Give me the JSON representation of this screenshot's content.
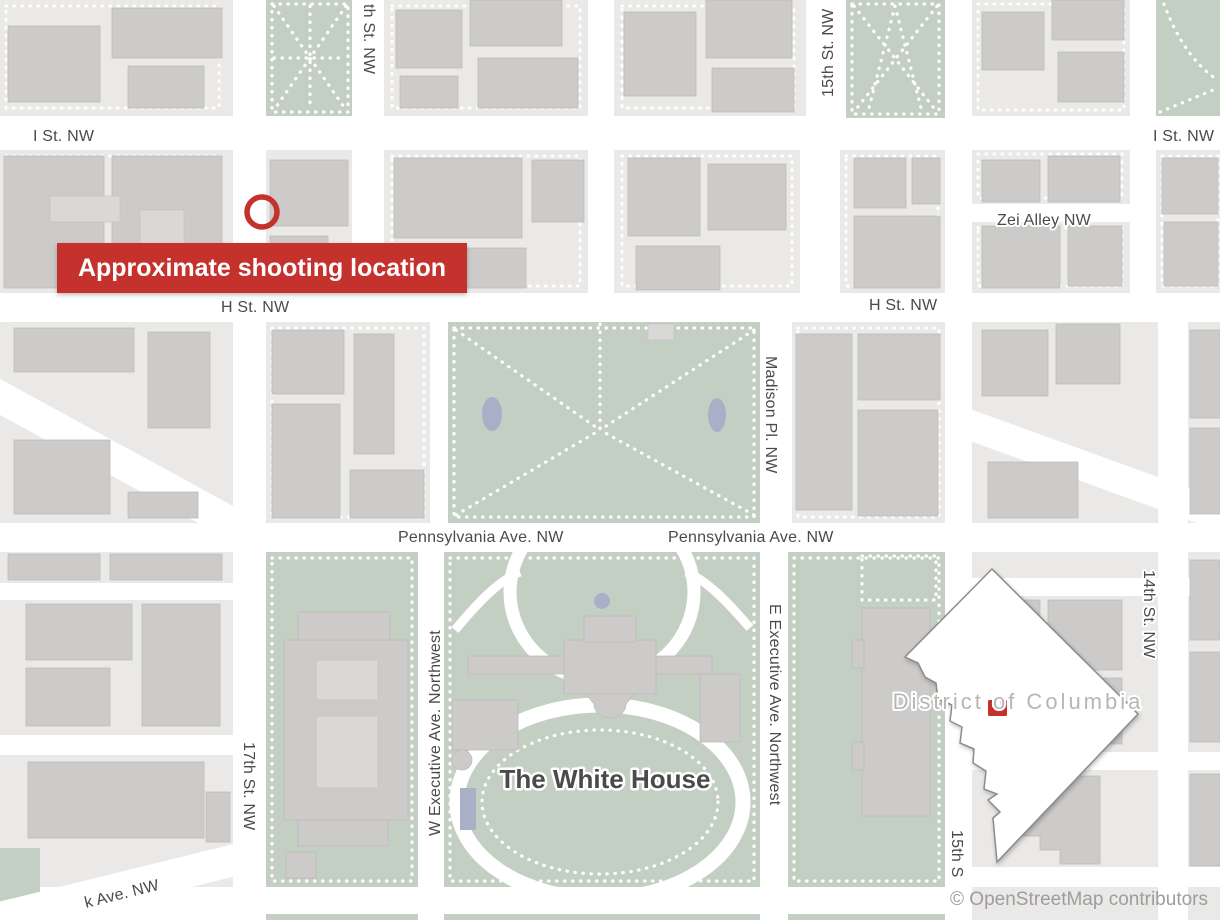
{
  "colors": {
    "accent_red": "#c5312d",
    "street_white": "#ffffff",
    "block_gray": "#eae9e7",
    "building_gray": "#cccbc9",
    "building_light": "#d9d8d6",
    "park_green": "#c4cfc3",
    "water_blue": "#a9afc7",
    "label_dark": "#4a4a4a",
    "label_light": "#b6b6b4",
    "attribution_gray": "#9d9d9d",
    "inset_stroke": "#8c8c8c"
  },
  "callout": {
    "text": "Approximate shooting location"
  },
  "streets": {
    "i_st_left": "I St. NW",
    "i_st_right": "I St. NW",
    "st16_top": "th St. NW",
    "st15_top": "15th St. NW",
    "zei_alley": "Zei Alley NW",
    "h_st_left": "H St. NW",
    "h_st_right": "H St. NW",
    "madison_pl": "Madison Pl. NW",
    "penn_ave_left": "Pennsylvania Ave. NW",
    "penn_ave_right": "Pennsylvania Ave. NW",
    "st17": "17th St. NW",
    "st14": "14th St. NW",
    "st15_bottom": "15th S",
    "w_executive": "W Executive Ave. Northwest",
    "e_executive": "E Executive Ave. Northwest",
    "ny_ave": "k Ave. NW"
  },
  "places": {
    "white_house": "The White House",
    "district": "District of Columbia"
  },
  "attribution": "© OpenStreetMap contributors"
}
